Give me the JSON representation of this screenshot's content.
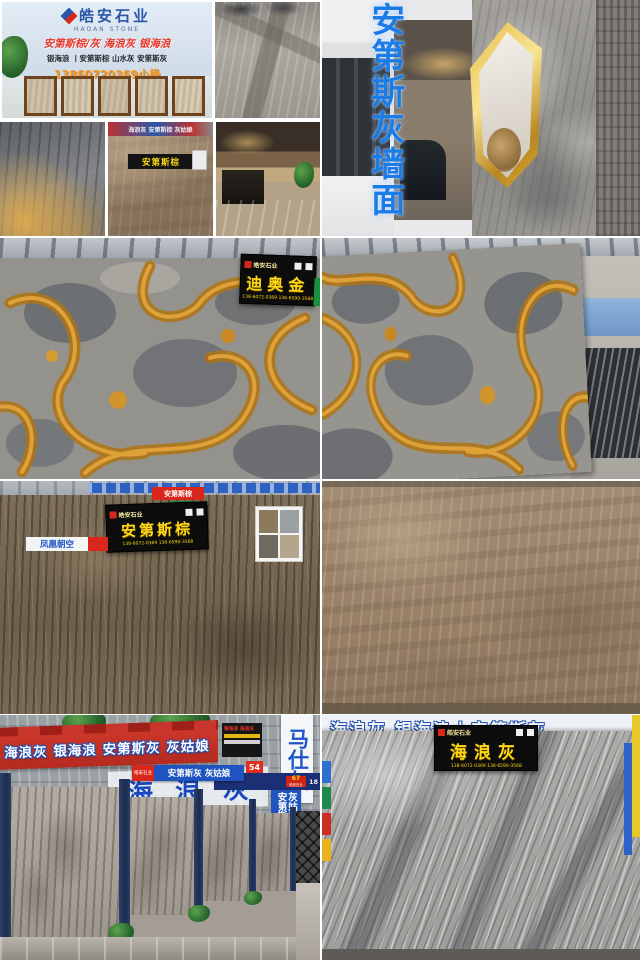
{
  "photos": {
    "storefront": {
      "brand_cn": "皓安石业",
      "brand_en": "HAOAN STONE",
      "red_line": "安第斯棕/灰  海浪灰  银海浪",
      "black_line": "银海浪 丨安第斯棕  山水灰  安第斯灰",
      "phone": "13860720369小杨"
    },
    "tan_slab": {
      "banner": "海浪灰 安第斯棕 灰姑娘",
      "tag": "安第斯棕"
    },
    "grey_wall": {
      "caption_vertical": "安第斯灰墙面"
    },
    "dior_gold": {
      "sign_logo": "皓安石业",
      "sign_title": "迪奥金",
      "sign_phone": "138-6072-0369 136-6590-3568"
    },
    "andes_brown": {
      "corner_tag": "安第斯棕",
      "sign_logo": "皓安石业",
      "sign_title": "安第斯棕",
      "sign_phone": "138-6072-0369 136-6590-3568",
      "left_label": "凤凰朝空"
    },
    "aisle": {
      "red_banner": "海浪灰 银海浪 安第斯灰 灰姑娘",
      "big_blue": "海浪灰",
      "mini_sign_line": "银海浪 海浪灰",
      "stall_number": "54",
      "blue_sign_logo": "皓安石业",
      "blue_sign_text": "安第斯灰 灰姑娘",
      "vertical_right": "马仕灰",
      "blue_v1": "安第斯灰",
      "blue_v2": "灰姑娘",
      "corner_number": "67",
      "corner_logo": "皓安石业",
      "small_number": "18"
    },
    "wave_grey": {
      "behind_banner": "海浪灰  银海浪丨安第斯灰",
      "sign_logo": "皓安石业",
      "sign_title": "海浪灰",
      "sign_phone": "138-6072-0369 136-6590-3568"
    }
  },
  "colors": {
    "accent_blue": "#1b7ce8",
    "sign_yellow": "#ffd814",
    "sign_red": "#d8281e",
    "vein_amber": "#c8821c"
  }
}
